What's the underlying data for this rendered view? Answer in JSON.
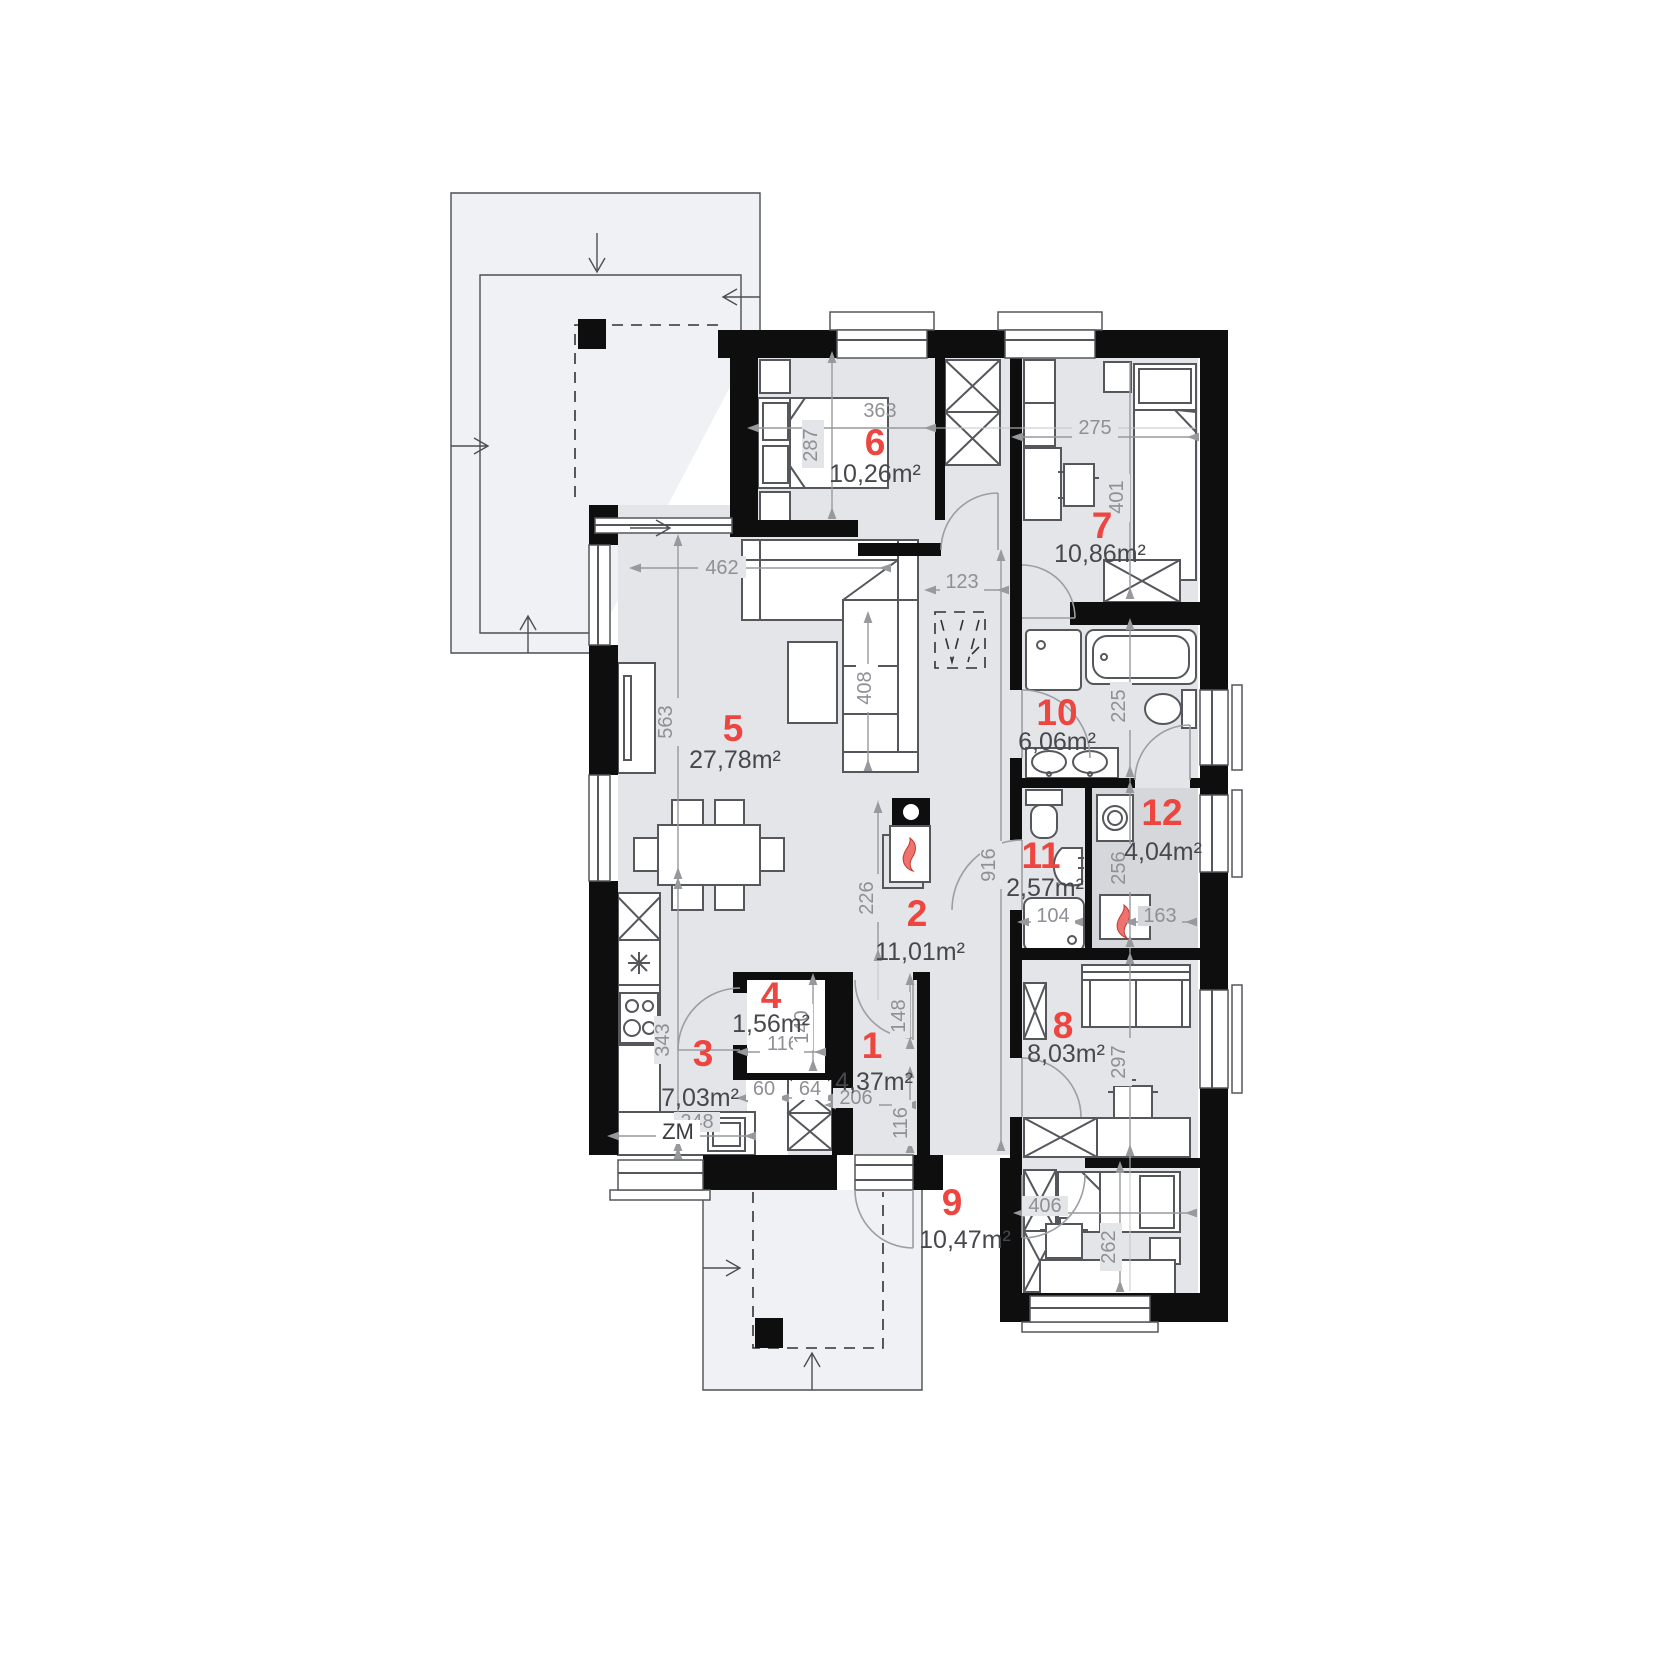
{
  "document": {
    "type": "architectural-floor-plan",
    "units": "cm"
  },
  "colors": {
    "wall": "#0e0e0e",
    "room_fill": "#e3e5e9",
    "utility_room_fill": "#d5d7db",
    "terrace_fill": "#eff1f5",
    "accent_red": "#ed4540",
    "dimension_gray": "#8e9095",
    "area_text": "#47484c"
  },
  "rooms": [
    {
      "num": "1",
      "area": "4,37m²"
    },
    {
      "num": "2",
      "area": "11,01m²"
    },
    {
      "num": "3",
      "area": "7,03m²"
    },
    {
      "num": "4",
      "area": "1,56m²"
    },
    {
      "num": "5",
      "area": "27,78m²"
    },
    {
      "num": "6",
      "area": "10,26m²"
    },
    {
      "num": "7",
      "area": "10,86m²"
    },
    {
      "num": "8",
      "area": "8,03m²"
    },
    {
      "num": "9",
      "area": "10,47m²"
    },
    {
      "num": "10",
      "area": "6,06m²"
    },
    {
      "num": "11",
      "area": "2,57m²"
    },
    {
      "num": "12",
      "area": "4,04m²"
    }
  ],
  "dimensions": {
    "living_width": "462",
    "hall_width": "123",
    "room6_width": "363",
    "room6_depth": "287",
    "room7_width": "275",
    "room7_depth": "401",
    "living_height": "563",
    "sofa_length": "408",
    "kitchen_height": "343",
    "kitchen_width": "248",
    "fireplace_wall": "226",
    "hall_length": "916",
    "room4_width": "116",
    "room4_depth": "140",
    "room1_width": "206",
    "room1_upper": "148",
    "room1_lower": "116",
    "niche_left": "60",
    "niche_right": "64",
    "shower_width": "104",
    "room12_width": "163",
    "room12_depth": "256",
    "room10_depth": "225",
    "room8_depth": "297",
    "room9_width": "406",
    "room9_depth": "262"
  },
  "labels": {
    "dishwasher": "ZM"
  }
}
